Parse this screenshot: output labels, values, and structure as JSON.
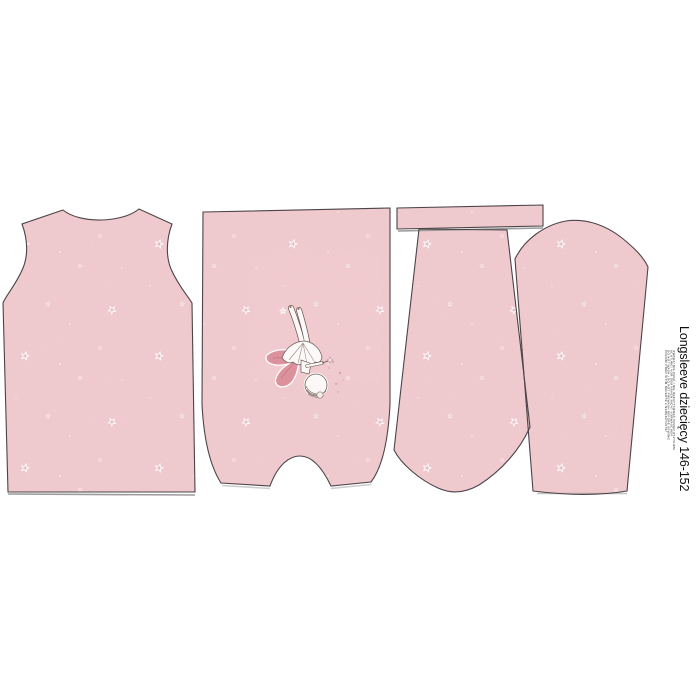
{
  "panel": {
    "title": "Longsleeve dziecięcy 146-152",
    "care_notes": [
      "UWAGA! NIE PRAĆ / NIE DEKATYZOWAĆ PRZED USZYCIEM",
      "ACHTUNG! VOR DEM NÄHEN NICHT VORWASCHEN",
      "DO NOT WASH / DO NOT PREWASH BEFORE SEWING",
      "POZOR! PŘED ŠITÍM NEPERTE A NEDEKATUJTE!"
    ],
    "fabric": {
      "base_color": "#f0c8cc",
      "motif": "scattered-stars",
      "star_color": "#e9bac0",
      "star_outline_color": "#ffffff",
      "piece_outline_color": "#4c4448",
      "background_color": "#ffffff"
    },
    "print": {
      "name": "fairy-upside-down",
      "wing_color": "#dd919c",
      "body_color": "#fbf8f7"
    },
    "pieces": [
      "back-bodice",
      "front-bodice-with-fairy-print",
      "neckband-strip",
      "sleeve-upside-down",
      "sleeve-upright"
    ]
  }
}
